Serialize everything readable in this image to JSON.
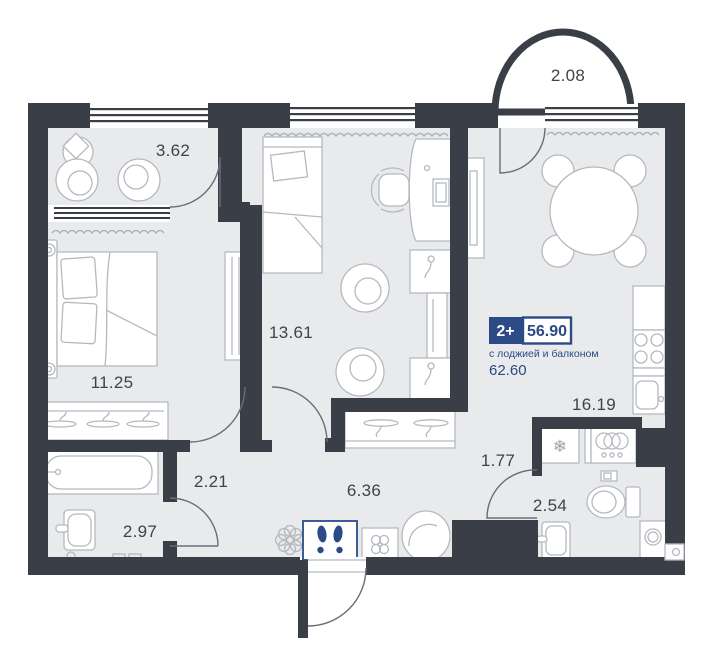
{
  "plan": {
    "badge": {
      "rooms_label": "2+",
      "area_main": "56.90",
      "area_note": "с лоджией и балконом",
      "area_total": "62.60"
    },
    "rooms": {
      "balcony_top": "2.08",
      "balcony_left": "3.62",
      "bedroom": "11.25",
      "children_room": "13.61",
      "kitchen_living": "16.19",
      "hall_small": "1.77",
      "hallway": "2.21",
      "corridor": "6.36",
      "bathroom": "2.97",
      "wc": "2.54"
    },
    "icons": {
      "fridge_glyph": "❄"
    },
    "colors": {
      "wall": "#3a3e47",
      "floor": "#e9eaec",
      "furniture_line": "#b5b9bf",
      "accent_blue": "#2b4a86",
      "label": "#3f434b"
    }
  }
}
